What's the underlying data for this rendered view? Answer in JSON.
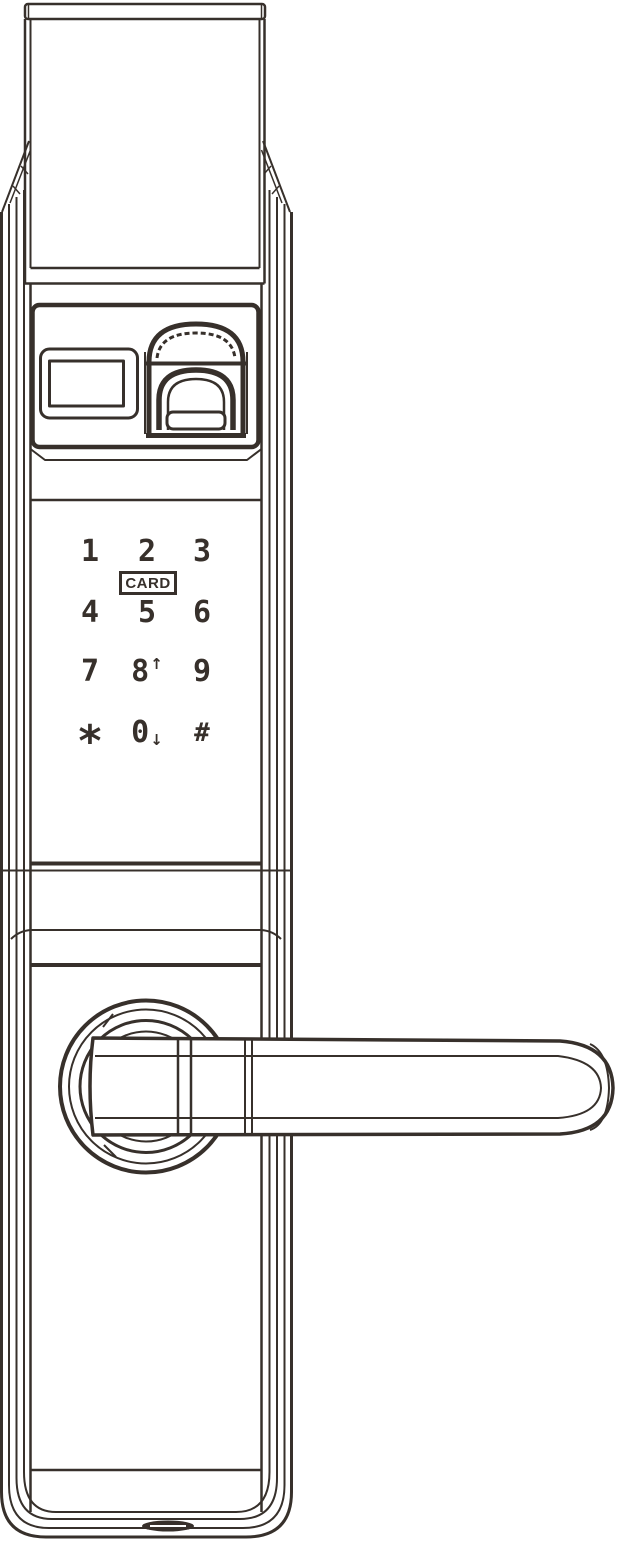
{
  "colors": {
    "line": "#37302b",
    "background": "#ffffff"
  },
  "keypad": {
    "keys": [
      {
        "id": "key-1",
        "label": "1"
      },
      {
        "id": "key-2",
        "label": "2"
      },
      {
        "id": "key-3",
        "label": "3"
      },
      {
        "id": "key-4",
        "label": "4"
      },
      {
        "id": "key-5",
        "label": "5"
      },
      {
        "id": "key-6",
        "label": "6"
      },
      {
        "id": "key-7",
        "label": "7"
      },
      {
        "id": "key-8",
        "label": "8",
        "sublabel": "↑"
      },
      {
        "id": "key-9",
        "label": "9"
      },
      {
        "id": "key-star",
        "label": "*"
      },
      {
        "id": "key-0",
        "label": "0",
        "sublabel": "↓"
      },
      {
        "id": "key-hash",
        "label": "#"
      }
    ],
    "card_label": "CARD"
  }
}
